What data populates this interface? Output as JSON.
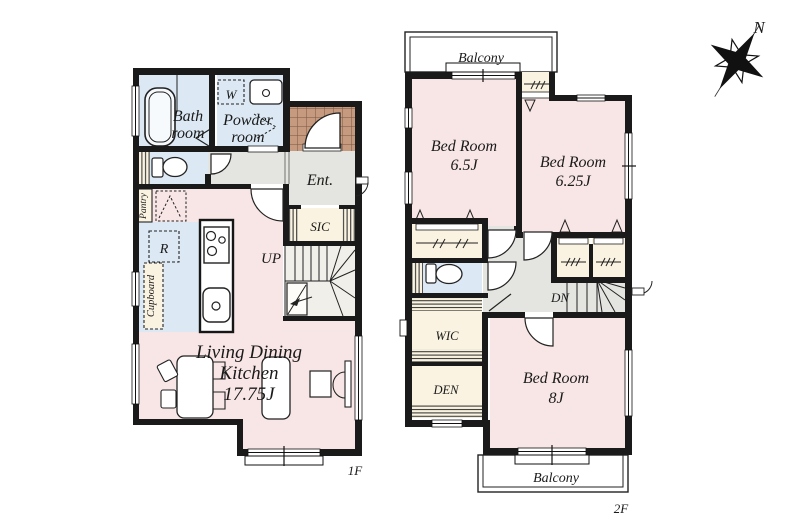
{
  "title": "Floor plan 1F / 2F",
  "compass": {
    "north": "N"
  },
  "floor1": {
    "label": "1F",
    "bath": [
      "Bath",
      "room"
    ],
    "powder": [
      "Powder",
      "room"
    ],
    "washer": "W",
    "entrance": "Ent.",
    "sic": "SIC",
    "up": "UP",
    "pantry": "Pantry",
    "fridge": "R",
    "cupboard": "Cupboard",
    "ldk": [
      "Living Dining",
      "Kitchen",
      "17.75J"
    ]
  },
  "floor2": {
    "label": "2F",
    "balcony_top": "Balcony",
    "balcony_bottom": "Balcony",
    "bedroom_65": [
      "Bed Room",
      "6.5J"
    ],
    "bedroom_625": [
      "Bed Room",
      "6.25J"
    ],
    "bedroom_8": [
      "Bed Room",
      "8J"
    ],
    "wic": "WIC",
    "den": "DEN",
    "dn": "DN"
  },
  "colors": {
    "wall": "#1a1a1a",
    "room_pink": "#f8e6e6",
    "wet_area_blue": "#dce9f4",
    "hall_gray": "#e4e4e0",
    "closet_cream": "#faf3e1",
    "stair_floor": "#f0efe9",
    "tile_brown": "#c69a7f"
  }
}
